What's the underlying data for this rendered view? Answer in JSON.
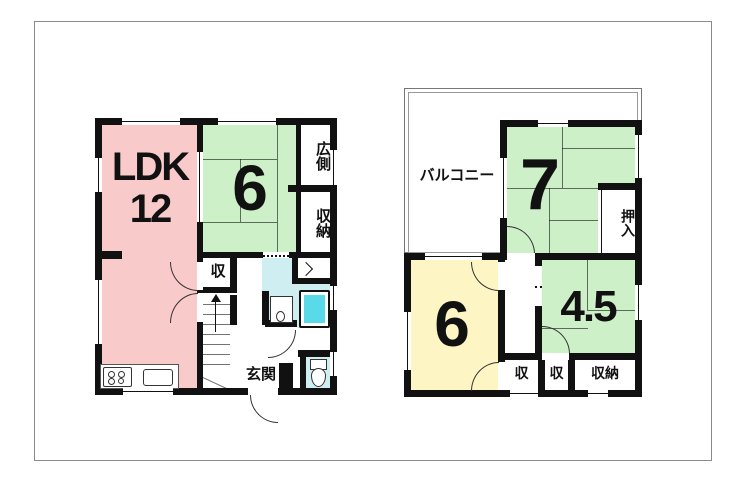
{
  "title": "間取り図",
  "palette": {
    "wall": "#111111",
    "ldk_pink": "#f8caca",
    "tatami_green": "#cdf0c8",
    "room_yellow": "#fdf5c3",
    "wet_area_cyan": "#cfeef2",
    "bathtub_cyan": "#5ad9e9",
    "frame_gray": "#8a8a8a"
  },
  "floor1": {
    "ldk_line1": "LDK",
    "ldk_line2": "12",
    "tatami6": "6",
    "hiroen": "広側",
    "shunou": "収納",
    "shu": "収",
    "genkan": "玄関"
  },
  "floor2": {
    "balcony": "バルコニー",
    "tatami7": "7",
    "oshiire": "押入",
    "room6": "6",
    "tatami45": "4.5",
    "shu_a": "収",
    "shu_b": "収",
    "shunou": "収納"
  }
}
